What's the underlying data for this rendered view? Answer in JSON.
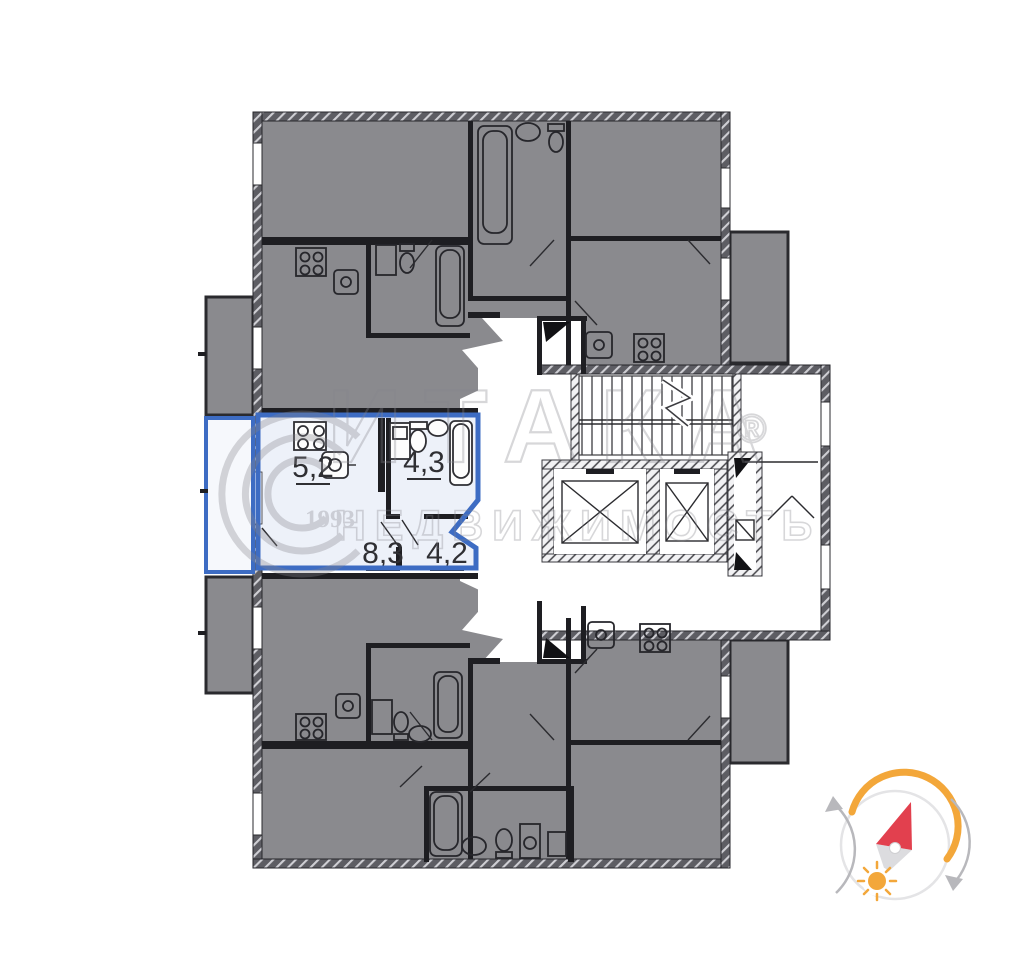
{
  "document": {
    "type": "residential floor plan",
    "description": "Building storey plan with one highlighted studio apartment, stair and elevator core, agency watermark and sun-path compass"
  },
  "highlighted_unit": {
    "outline_color": "#3d6cc3",
    "fill_color": "#edf1f9",
    "areas": [
      {
        "room": "kitchen-living",
        "value": "5,2"
      },
      {
        "room": "bathroom",
        "value": "4,3"
      },
      {
        "room": "main-room",
        "value": "8,3"
      },
      {
        "room": "hallway",
        "value": "4,2"
      }
    ]
  },
  "plan_colors": {
    "other_units_gray": "#8a8a8e",
    "wall_hatch_gray": "#5d5d63",
    "line_dark": "#2a2a2e"
  },
  "watermark": {
    "brand": "ИТАКА",
    "registered_mark": "®",
    "founded_year": "1993",
    "subtitle": "НЕДВИЖИМОСТЬ",
    "color": "#85858c"
  },
  "compass": {
    "arc_color": "#f3a73a",
    "needle_color": "#e2404e",
    "sun_color": "#f3a73a",
    "arrow_color": "#b8b8bc",
    "ring_color": "#e4e4e6"
  }
}
